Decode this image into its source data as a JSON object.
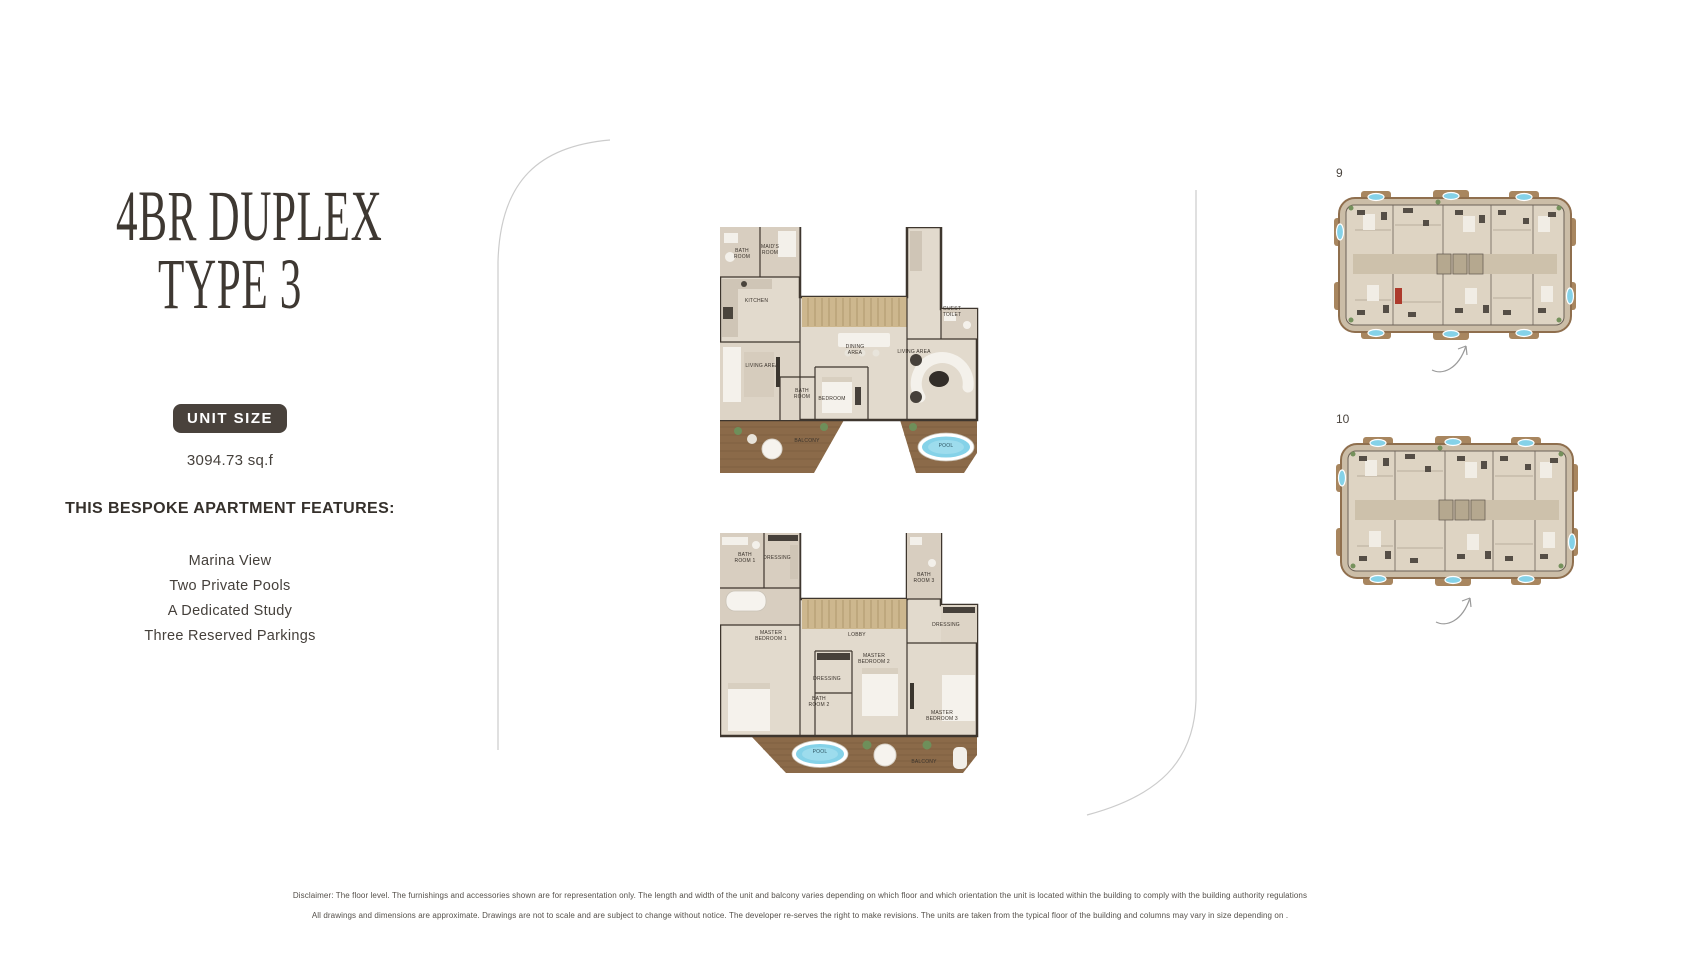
{
  "sidebar": {
    "title_line1": "4BR DUPLEX",
    "title_line2": "TYPE 3",
    "unit_size_badge": "UNIT SIZE",
    "unit_size_value": "3094.73 sq.f",
    "features_heading": "THIS BESPOKE APARTMENT FEATURES:",
    "features": [
      "Marina View",
      "Two Private Pools",
      "A Dedicated Study",
      "Three Reserved Parkings"
    ]
  },
  "upper_plan": {
    "rooms": {
      "bath_room": "BATH ROOM",
      "maids_room": "MAID'S ROOM",
      "kitchen": "KITCHEN",
      "living_area_left": "LIVING AREA",
      "dining_area": "DINING AREA",
      "living_area_right": "LIVING AREA",
      "guest_toilet": "GUEST TOILET",
      "bath_room_2": "BATH ROOM",
      "bedroom": "BEDROOM",
      "balcony": "BALCONY",
      "pool": "POOL"
    }
  },
  "lower_plan": {
    "rooms": {
      "bath_room_1": "BATH ROOM 1",
      "dressing_1": "DRESSING",
      "master_bedroom_1": "MASTER BEDROOM 1",
      "lobby": "LOBBY",
      "master_bedroom_2": "MASTER BEDROOM 2",
      "dressing_2": "DRESSING",
      "bath_room_2": "BATH ROOM 2",
      "bath_room_3": "BATH ROOM 3",
      "dressing_3": "DRESSING",
      "master_bedroom_3": "MASTER BEDROOM 3",
      "pool": "POOL",
      "balcony": "BALCONY"
    }
  },
  "key_plans": [
    {
      "label": "9"
    },
    {
      "label": "10"
    }
  ],
  "footer": {
    "disclaimer_line1": "Disclaimer: The floor level. The furnishings and accessories shown are for representation only. The length and width of the unit and balcony varies depending on which floor and which orientation the unit is located within the building to comply with the building authority regulations",
    "disclaimer_line2": "All drawings and dimensions are approximate. Drawings are not to scale and are subject to change without notice. The developer re-serves  the right to make revisions. The units are taken from the typical floor of the building and columns may vary in size depending on ."
  },
  "colors": {
    "background": "#ffffff",
    "text_dark": "#3e3832",
    "badge_bg": "#49423c",
    "badge_text": "#ffffff",
    "pool": "#85d2e8",
    "wood_deck": "#8b6a49",
    "floor": "#e2dacd",
    "wall": "#3e362e",
    "divider_line": "#cccccc"
  }
}
